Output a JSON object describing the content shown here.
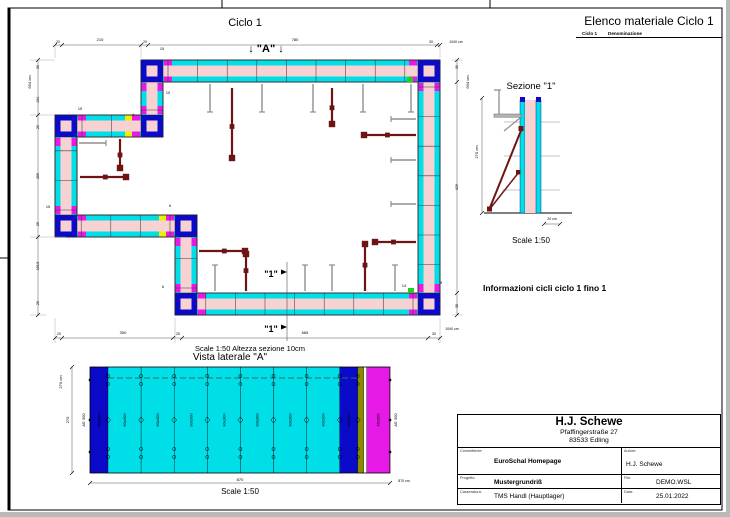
{
  "colors": {
    "cyan": "#00dfe8",
    "pink": "#f8d2d2",
    "navy": "#0a0ac8",
    "magenta": "#e619e6",
    "yellow": "#f0ee00",
    "green": "#1ad41a",
    "olive": "#8b8b00",
    "prop_red": "#6f1414",
    "dim": "#555555",
    "bracket_gray": "#8f8f8f"
  },
  "plan": {
    "title": "Ciclo 1",
    "marker_a": "↓ \"A\" ↓",
    "scale_note": "Scale 1:50   Altezza sezione 10cm",
    "cut": {
      "label": "\"1\"",
      "positions": [
        [
          271,
          277
        ],
        [
          271,
          332
        ]
      ]
    },
    "dims": [
      {
        "t": "20",
        "x": 58,
        "y": 43,
        "s": 3.5
      },
      {
        "t": "210",
        "x": 100,
        "y": 41,
        "s": 4
      },
      {
        "t": "20",
        "x": 145,
        "y": 43,
        "s": 3.5
      },
      {
        "t": "780",
        "x": 295,
        "y": 41,
        "s": 4
      },
      {
        "t": "30",
        "x": 431,
        "y": 43,
        "s": 3.5
      },
      {
        "t": "1040 cm",
        "x": 456,
        "y": 43,
        "s": 3.5
      },
      {
        "t": "20",
        "x": 59,
        "y": 335,
        "s": 3.5
      },
      {
        "t": "300",
        "x": 123,
        "y": 334,
        "s": 4
      },
      {
        "t": "25",
        "x": 178,
        "y": 335,
        "s": 3.5
      },
      {
        "t": "665",
        "x": 305,
        "y": 334,
        "s": 4
      },
      {
        "t": "30",
        "x": 434,
        "y": 335,
        "s": 3.5
      },
      {
        "t": "1040 cm",
        "x": 452,
        "y": 330,
        "s": 3.5
      },
      {
        "t": "694 cm",
        "x": 31,
        "y": 82,
        "s": 4,
        "r": -90
      },
      {
        "t": "30",
        "x": 39,
        "y": 67,
        "s": 3.5,
        "r": -90
      },
      {
        "t": "134",
        "x": 39,
        "y": 100,
        "s": 3.5,
        "r": -90
      },
      {
        "t": "20",
        "x": 39,
        "y": 127,
        "s": 3.5,
        "r": -90
      },
      {
        "t": "255",
        "x": 39,
        "y": 176,
        "s": 3.5,
        "r": -90
      },
      {
        "t": "25",
        "x": 39,
        "y": 224,
        "s": 3.5,
        "r": -90
      },
      {
        "t": "168,5",
        "x": 39,
        "y": 266,
        "s": 3.5,
        "r": -90
      },
      {
        "t": "25",
        "x": 39,
        "y": 303,
        "s": 3.5,
        "r": -90
      },
      {
        "t": "694 cm",
        "x": 469,
        "y": 82,
        "s": 4,
        "r": -90
      },
      {
        "t": "30",
        "x": 458,
        "y": 67,
        "s": 3.5,
        "r": -90
      },
      {
        "t": "629",
        "x": 458,
        "y": 187,
        "s": 3.5,
        "r": -90
      },
      {
        "t": "35",
        "x": 458,
        "y": 306,
        "s": 3.5,
        "r": -90
      }
    ],
    "small_labels": [
      {
        "t": "15",
        "x": 162,
        "y": 50
      },
      {
        "t": "10",
        "x": 168,
        "y": 94
      },
      {
        "t": "15",
        "x": 80,
        "y": 110
      },
      {
        "t": "4",
        "x": 133,
        "y": 116
      },
      {
        "t": "15",
        "x": 48,
        "y": 208
      },
      {
        "t": "6",
        "x": 170,
        "y": 207
      },
      {
        "t": "6",
        "x": 163,
        "y": 288
      },
      {
        "t": "14",
        "x": 404,
        "y": 287
      },
      {
        "t": "9",
        "x": 441,
        "y": 284
      }
    ]
  },
  "sezione": {
    "title": "Sezione \"1\"",
    "scale": "Scale 1:50",
    "dim_height": "270 cm",
    "dim_width": "20 cm"
  },
  "vista": {
    "title": "Vista laterale \"A\"",
    "scale": "Scale 1:50",
    "dim_left_total": "270 cm",
    "dim_left": "270",
    "dim_bottom": "870",
    "dim_bottom_total": "870 cm",
    "edge_label_left": "AE 300",
    "edge_label_right": "AE 300",
    "panels": [
      {
        "w": 18,
        "c": "navy",
        "label": "60x300"
      },
      {
        "w": 33.1,
        "c": "cyan",
        "label": "90x300"
      },
      {
        "w": 33.1,
        "c": "cyan",
        "label": "90x300"
      },
      {
        "w": 33.1,
        "c": "cyan",
        "label": "90x300"
      },
      {
        "w": 33.1,
        "c": "cyan",
        "label": "90x300"
      },
      {
        "w": 33.1,
        "c": "cyan",
        "label": "90x300"
      },
      {
        "w": 33.1,
        "c": "cyan",
        "label": "90x300"
      },
      {
        "w": 33.1,
        "c": "cyan",
        "label": "90x300"
      },
      {
        "w": 18,
        "c": "navy",
        "label": "60x300"
      },
      {
        "w": 6,
        "c": "olive",
        "label": ""
      },
      {
        "w": 3,
        "c": "white",
        "label": ""
      },
      {
        "w": 23,
        "c": "magenta",
        "label": "45x300"
      }
    ]
  },
  "materiale": {
    "title": "Elenco materiale  Ciclo 1",
    "col1": "Ciclo 1",
    "col2": "Denominazione",
    "sections": [
      {
        "name": "Pannelli",
        "items": [
          {
            "qty": "46",
            "name": "HANDY PANEL HP-S 90 x 300"
          },
          {
            "qty": "16",
            "name": "HANDY PANEL HP-S 60 x 300"
          },
          {
            "qty": "21",
            "name": "HANDY PANEL HP-S 45 x 300"
          },
          {
            "qty": "6",
            "name": "HANDY PANEL HP-S 30 x 300"
          },
          {
            "qty": "3",
            "name": "HANDY INNER CORNER ELEMENT HK-I 30 x 300"
          },
          {
            "qty": "2",
            "name": "HANDY INNER CORNER ELEMENT HK-I 25 x 300"
          },
          {
            "qty": "3",
            "name": "HANDY INNER CORNER ELEMENT HK-I 20 x 300"
          },
          {
            "qty": "6",
            "name": "HANDY OUTER CORNER ELEMENT HD-K 300"
          }
        ]
      },
      {
        "name": "Accessori",
        "items": [
          {
            "qty": "432",
            "name": "HANDY PANEL LOCK \"REX HANDY\""
          },
          {
            "qty": "36",
            "name": "HANDY PANEL LOCK"
          },
          {
            "qty": "270",
            "name": "WIRBELMUTTER"
          },
          {
            "qty": "138",
            "name": "Ankerstab S-75"
          },
          {
            "qty": "28",
            "name": "HANDY CAT-WALK BRACKET \"HANDY Type\""
          },
          {
            "qty": "11",
            "name": "Std. Push-Pull Prop PY-S 301"
          },
          {
            "qty": "11",
            "name": "PROP Base Plate"
          },
          {
            "qty": "11",
            "name": "PROP SHOE \"HANDY Type\""
          }
        ]
      },
      {
        "name": "Altro",
        "items": [
          {
            "qty": "4",
            "name": "Parte in legno 15 x 12 x 300 cm"
          },
          {
            "qty": "2",
            "name": "Parte in legno 10 x 12 x 300 cm"
          },
          {
            "qty": "51",
            "name": "Tubo in PVC 30 cm (da parte del cliente)"
          },
          {
            "qty": "1",
            "name": "Parte in legno 9 x 12 x 300 cm"
          },
          {
            "qty": "1",
            "name": "Parte in legno 14 x 12 x 300 cm"
          },
          {
            "qty": "66",
            "name": "Tubo in PVC 25 cm (da parte del cliente)"
          },
          {
            "qty": "4",
            "name": "Parte in legno 5 x 12 x 300 cm"
          },
          {
            "qty": "18",
            "name": "Tubo in PVC 20 cm (da parte del cliente)"
          },
          {
            "qty": "2",
            "name": "Parte in legno 4 x 12 x 300 cm"
          }
        ]
      }
    ]
  },
  "info": {
    "title": "Informazioni cicli  ciclo 1 fino 1",
    "headers": [
      "Informazioni",
      "Fornitura",
      "Ciclo 1"
    ],
    "rows": [
      [
        "Sup. di armatura",
        "180,79 m²",
        "180,79 m²"
      ],
      [
        "Sup. totale pannelli",
        "196,56 m²",
        "196,56 m²"
      ],
      [
        "Impegno magazzino",
        "100 %",
        "100 %"
      ],
      [
        "Volume cemento armato",
        "24,02 m³",
        "24,02 m³"
      ],
      [
        "Metri correnti",
        "34,580 m",
        "34,580 m"
      ],
      [
        "Altezza pareti",
        "270,0 cm",
        "270,0 cm"
      ],
      [
        "Peso cassero",
        "13845,9 kg",
        "13845,9 kg"
      ],
      [
        "Tempo di casseratura",
        "0:00 ora",
        "0:00 ora"
      ],
      [
        "Tempo di disarmo",
        "0:00 ora",
        "0:00 ora"
      ],
      [
        "prezzo di armatura",
        "0,00 €",
        "0,00 €"
      ]
    ]
  },
  "notes": [
    "N.B. IL DISEGNO DEVE ESSERE CONTROLLATO SOTTO LA RESPONSABILITA' DEL COSTRUTTORE!",
    "N.B. OSSERVARE LE ISTRUZIONI D'USO!",
    "N.B. OSSERVARE LE ISTRUZIONI D'USO!"
  ],
  "titleblock": {
    "company": "H.J. Schewe",
    "address1": "Pfaffingerstraße 27",
    "address2": "83533 Edling",
    "committente_label": "Committente:",
    "committente": "EuroSchal Homepage",
    "autore_label": "Autore:",
    "autore": "H.J. Schewe",
    "progetto_label": "Progetto:",
    "progetto": "Mustergrundriß",
    "file_label": "File:",
    "file": "DEMO.WSL",
    "casseratura_label": "Casseratura:",
    "casseratura": "TMS Handl (Hauptlager)",
    "data_label": "Data:",
    "data": "25.01.2022"
  }
}
